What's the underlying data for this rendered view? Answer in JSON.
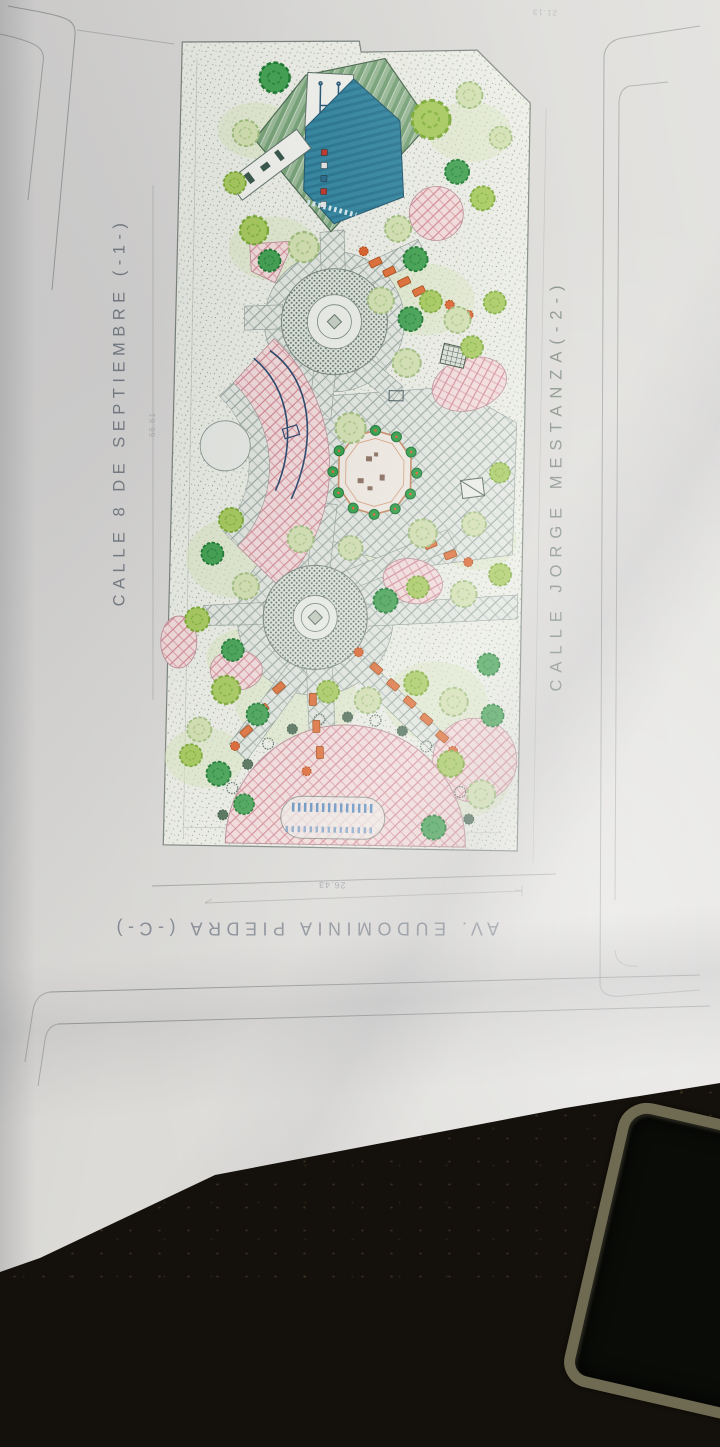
{
  "scene": {
    "description": "Photograph of a printed landscape site plan lying on a dark table, phone corner visible bottom right",
    "paper_color": "#dcdbd8",
    "table_color": "#14100b"
  },
  "plan": {
    "street_labels": {
      "left": "CALLE 8 DE SEPTIEMBRE  (-1-)",
      "right": "CALLE JORGE MESTANZA(-2-)",
      "bottom": "AV. EUDOMINIA PIEDRA (-C-)"
    },
    "dimensions": {
      "bottom_width": "26.43",
      "left_height": "66.61",
      "top_right": "21.13"
    },
    "features": {
      "court": "multi-purpose-court-with-canopy",
      "gazebo": "central-octagonal-gazebo",
      "upper_plaza": "north-circular-plaza",
      "lower_plaza": "south-circular-plaza",
      "walkway": "curved-pink-walkway",
      "dome_plaza": "semicircular-plaza-with-water-feature",
      "trees": "park-trees-and-shrubs",
      "benches": "park-benches"
    },
    "palette": {
      "walkway_pink": "#f4dedd",
      "paving_grey": "#e4e9e2",
      "court_teal": "#3a8aa4",
      "canopy_green": "#7aa57b",
      "tree_green": "#46a455",
      "bench_orange": "#e0713a",
      "water_blue": "#4a82bb"
    }
  }
}
